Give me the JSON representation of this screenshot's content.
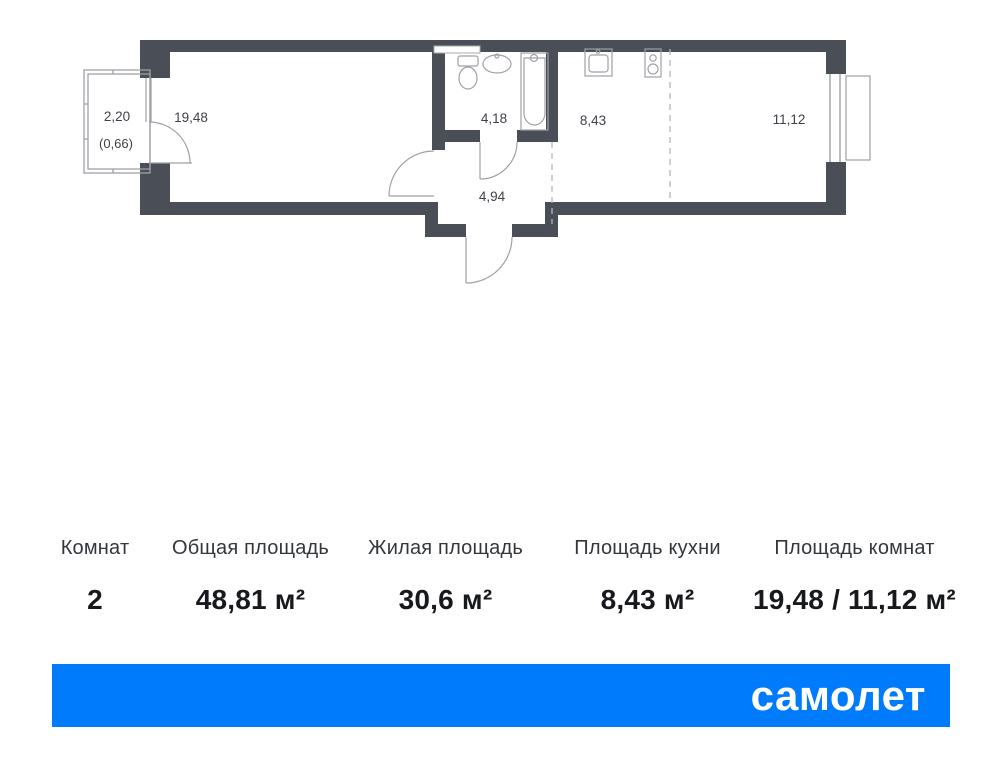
{
  "plan": {
    "balcony": {
      "area": "2,20",
      "area_reduced": "(0,66)"
    },
    "labels": {
      "living_room": "19,48",
      "bathroom": "4,18",
      "hallway": "4,94",
      "kitchen": "8,43",
      "bedroom": "11,12"
    },
    "colors": {
      "wall": "#4a4e57",
      "thin_line": "#9ea1a6",
      "dashed_line": "#b3b6bb",
      "label_text": "#3d4148"
    }
  },
  "summary": {
    "columns": [
      {
        "label": "Комнат",
        "value": "2"
      },
      {
        "label": "Общая площадь",
        "value": "48,81 м²"
      },
      {
        "label": "Жилая площадь",
        "value": "30,6 м²"
      },
      {
        "label": "Площадь кухни",
        "value": "8,43 м²"
      },
      {
        "label": "Площадь комнат",
        "value": "19,48 / 11,12 м²"
      }
    ]
  },
  "brand": {
    "name": "самолет",
    "color": "#007bfb",
    "text_color": "#ffffff"
  }
}
